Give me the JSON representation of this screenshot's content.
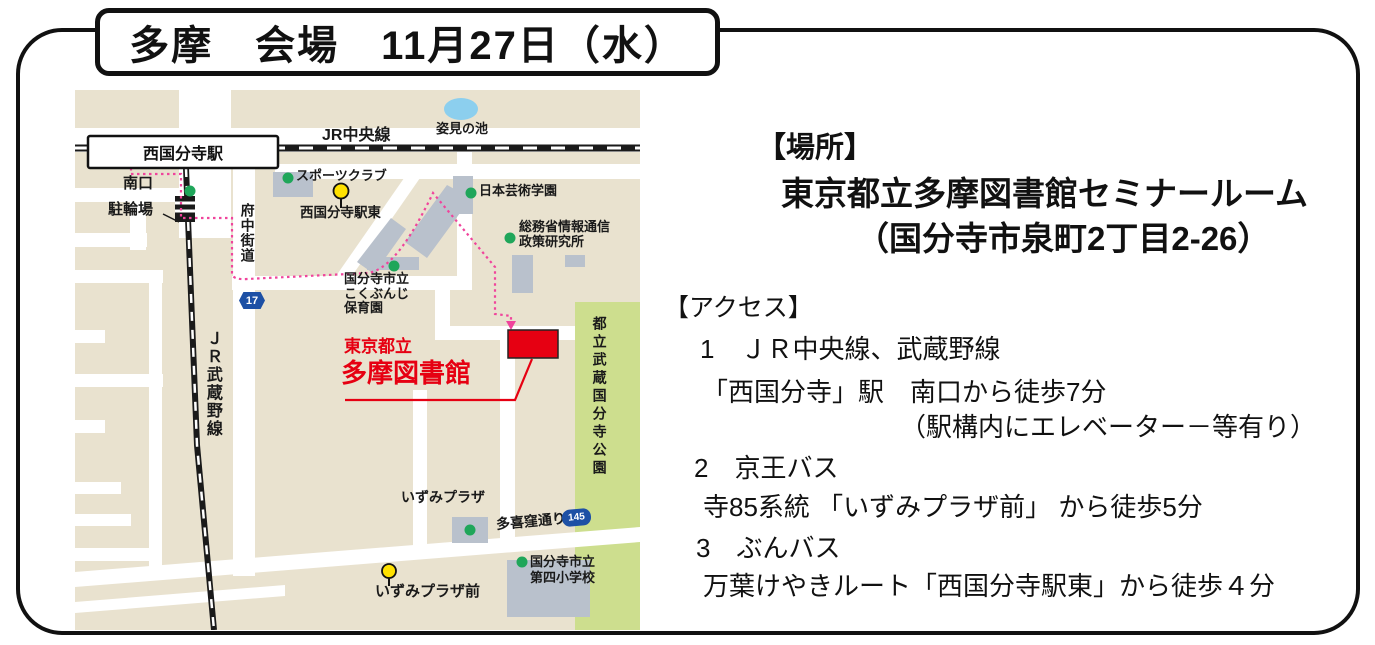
{
  "title": "多摩　会場　11月27日（水）",
  "venue": {
    "header": "【場所】",
    "name": "東京都立多摩図書館セミナールーム",
    "address": "（国分寺市泉町2丁目2-26）"
  },
  "access": {
    "header": "【アクセス】",
    "items": [
      {
        "label": "1　ＪＲ中央線、武蔵野線",
        "detail": "「西国分寺」駅　南口から徒歩7分",
        "note": "（駅構内にエレベーター－等有り）"
      },
      {
        "label": "2　京王バス",
        "detail": "寺85系統 「いずみプラザ前」 から徒歩5分"
      },
      {
        "label": "3　ぶんバス",
        "detail": "万葉けやきルート「西国分寺駅東」から徒歩４分"
      }
    ]
  },
  "map": {
    "labels": {
      "jr_chuo_line": "JR中央線",
      "jr_musashino_line": "ＪＲ武蔵野線",
      "station": "西国分寺駅",
      "south_exit": "南口",
      "bicycle_parking": "駐輪場",
      "sports_club": "スポーツクラブ",
      "nishikokubunji_eki_higashi": "西国分寺駅東",
      "fuchu_kaido": "府中街道",
      "route_17": "17",
      "sugatami_pond": "姿見の池",
      "nihon_geijutsu_gakuen": "日本芸術学園",
      "somusho_line1": "総務省情報通信",
      "somusho_line2": "政策研究所",
      "hoikuen_line1": "国分寺市立",
      "hoikuen_line2": "こくぶんじ",
      "hoikuen_line3": "保育園",
      "library_line1": "東京都立",
      "library_line2": "多摩図書館",
      "park": "都立武蔵国分寺公園",
      "izumi_plaza": "いずみプラザ",
      "takikubo_dori": "多喜窪通り",
      "route_145": "145",
      "izumi_plaza_mae": "いずみプラザ前",
      "shogakko_line1": "国分寺市立",
      "shogakko_line2": "第四小学校"
    },
    "colors": {
      "map_background": "#e9e2cf",
      "road": "#ffffff",
      "building": "#b9c1cc",
      "park_green": "#cdde8e",
      "pond_blue": "#8ccfee",
      "poi_green": "#1fa65a",
      "bus_stop_yellow": "#ffe100",
      "library_red": "#e60012",
      "route_pink": "#f0449c",
      "route_shield_blue": "#1d50a5",
      "railway_black": "#1a1a1a"
    }
  }
}
